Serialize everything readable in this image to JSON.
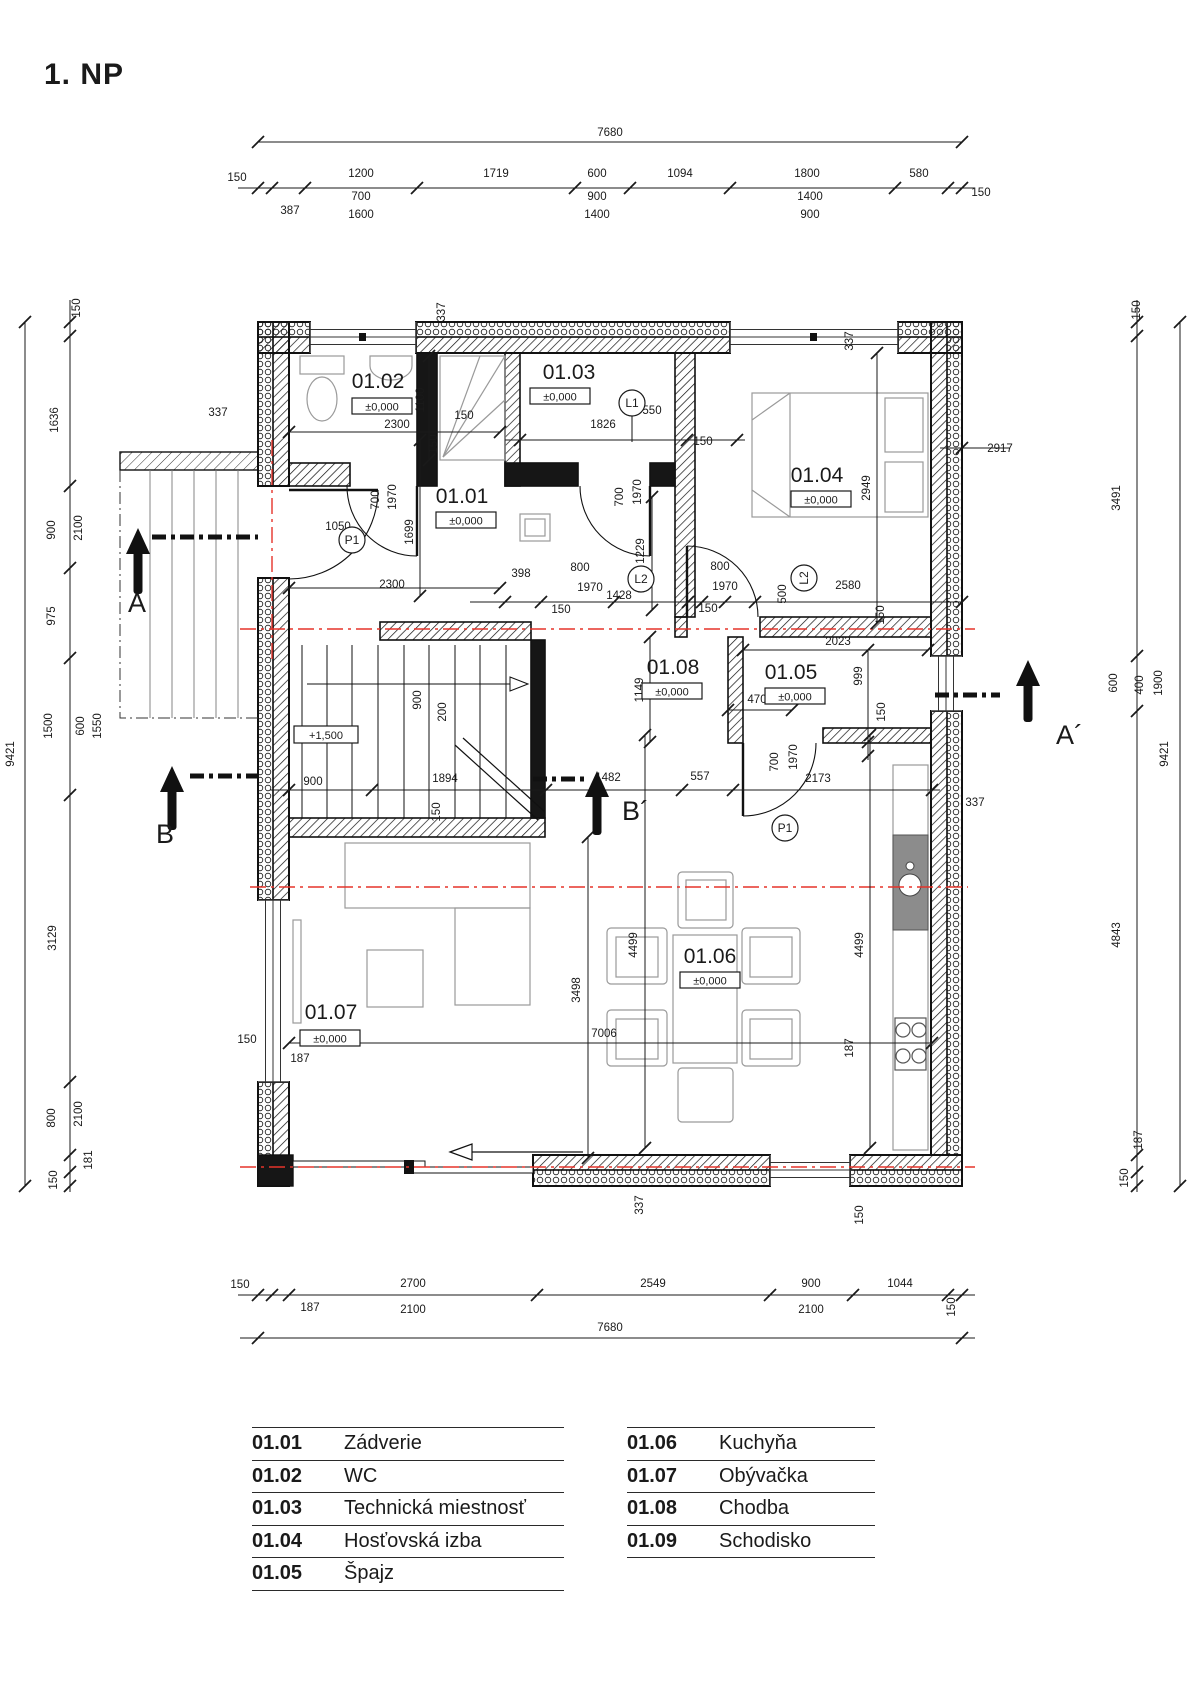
{
  "title": "1. NP",
  "colors": {
    "line": "#1a1a1a",
    "wall_fill": "#161616",
    "furniture": "#9a9a9a",
    "red_axis": "#e5332a"
  },
  "legend": {
    "columns": [
      {
        "rows": [
          {
            "code": "01.01",
            "name": "Zádverie"
          },
          {
            "code": "01.02",
            "name": "WC"
          },
          {
            "code": "01.03",
            "name": "Technická miestnosť"
          },
          {
            "code": "01.04",
            "name": "Hosťovská izba"
          },
          {
            "code": "01.05",
            "name": "Špajz"
          }
        ]
      },
      {
        "rows": [
          {
            "code": "01.06",
            "name": "Kuchyňa"
          },
          {
            "code": "01.07",
            "name": "Obývačka"
          },
          {
            "code": "01.08",
            "name": "Chodba"
          },
          {
            "code": "01.09",
            "name": "Schodisko"
          }
        ]
      }
    ]
  },
  "rooms": [
    {
      "code": "01.02",
      "elev": "±0,000",
      "x": 378,
      "y": 388,
      "bx": 382,
      "by": 398
    },
    {
      "code": "01.03",
      "elev": "±0,000",
      "x": 569,
      "y": 379,
      "bx": 560,
      "by": 388
    },
    {
      "code": "01.04",
      "elev": "±0,000",
      "x": 817,
      "y": 482,
      "bx": 821,
      "by": 491
    },
    {
      "code": "01.01",
      "elev": "±0,000",
      "x": 462,
      "y": 503,
      "bx": 466,
      "by": 512
    },
    {
      "code": "01.08",
      "elev": "±0,000",
      "x": 673,
      "y": 674,
      "bx": 672,
      "by": 683
    },
    {
      "code": "01.05",
      "elev": "±0,000",
      "x": 791,
      "y": 679,
      "bx": 795,
      "by": 688
    },
    {
      "code": "01.06",
      "elev": "±0,000",
      "x": 710,
      "y": 963,
      "bx": 710,
      "by": 972
    },
    {
      "code": "01.07",
      "elev": "±0,000",
      "x": 331,
      "y": 1019,
      "bx": 330,
      "by": 1030
    }
  ],
  "extra_boxes": [
    {
      "t": "+1,500",
      "x": 326,
      "y": 738
    }
  ],
  "door_tags": [
    {
      "t": "L1",
      "x": 632,
      "y": 403,
      "r": 0
    },
    {
      "t": "L2",
      "x": 641,
      "y": 579,
      "r": 0
    },
    {
      "t": "L2",
      "x": 804,
      "y": 578,
      "r": 1
    },
    {
      "t": "P1",
      "x": 352,
      "y": 540,
      "r": 0
    },
    {
      "t": "P1",
      "x": 785,
      "y": 828,
      "r": 0
    }
  ],
  "sections": [
    {
      "label": "A",
      "lx": 128,
      "ly": 612,
      "line": [
        152,
        537,
        258,
        537
      ],
      "ax": 138,
      "atip": 528,
      "atail": 594
    },
    {
      "label": "A´",
      "lx": 1056,
      "ly": 744,
      "line": [
        935,
        695,
        1000,
        695
      ],
      "ax": 1028,
      "atip": 660,
      "atail": 722
    },
    {
      "label": "B",
      "lx": 156,
      "ly": 843,
      "line": [
        190,
        776,
        258,
        776
      ],
      "ax": 172,
      "atip": 766,
      "atail": 830
    },
    {
      "label": "B´",
      "lx": 622,
      "ly": 820,
      "line": [
        533,
        779,
        585,
        779
      ],
      "ax": 597,
      "atip": 771,
      "atail": 835
    }
  ],
  "dim_lines": [
    {
      "x1": 258,
      "y1": 142,
      "x2": 962,
      "y2": 142,
      "t": [
        [
          258,
          142
        ],
        [
          962,
          142
        ]
      ]
    },
    {
      "x1": 238,
      "y1": 188,
      "x2": 975,
      "y2": 188,
      "t": [
        [
          258,
          188
        ],
        [
          272,
          188
        ],
        [
          305,
          188
        ],
        [
          417,
          188
        ],
        [
          575,
          188
        ],
        [
          630,
          188
        ],
        [
          730,
          188
        ],
        [
          895,
          188
        ],
        [
          948,
          188
        ],
        [
          962,
          188
        ]
      ]
    },
    {
      "x1": 25,
      "y1": 322,
      "x2": 25,
      "y2": 1186,
      "t": [
        [
          25,
          322
        ],
        [
          25,
          1186
        ]
      ]
    },
    {
      "x1": 70,
      "y1": 300,
      "x2": 70,
      "y2": 1192,
      "t": [
        [
          70,
          322
        ],
        [
          70,
          336
        ],
        [
          70,
          486
        ],
        [
          70,
          568
        ],
        [
          70,
          658
        ],
        [
          70,
          795
        ],
        [
          70,
          1082
        ],
        [
          70,
          1155
        ],
        [
          70,
          1172
        ],
        [
          70,
          1186
        ]
      ]
    },
    {
      "x1": 1137,
      "y1": 300,
      "x2": 1137,
      "y2": 1192,
      "t": [
        [
          1137,
          322
        ],
        [
          1137,
          336
        ],
        [
          1137,
          656
        ],
        [
          1137,
          711
        ],
        [
          1137,
          1155
        ],
        [
          1137,
          1172
        ],
        [
          1137,
          1186
        ]
      ]
    },
    {
      "x1": 1180,
      "y1": 322,
      "x2": 1180,
      "y2": 1186,
      "t": [
        [
          1180,
          322
        ],
        [
          1180,
          1186
        ]
      ]
    },
    {
      "x1": 238,
      "y1": 1295,
      "x2": 975,
      "y2": 1295,
      "t": [
        [
          258,
          1295
        ],
        [
          272,
          1295
        ],
        [
          289,
          1295
        ],
        [
          537,
          1295
        ],
        [
          770,
          1295
        ],
        [
          853,
          1295
        ],
        [
          948,
          1295
        ],
        [
          962,
          1295
        ]
      ]
    },
    {
      "x1": 240,
      "y1": 1338,
      "x2": 975,
      "y2": 1338,
      "t": [
        [
          258,
          1338
        ],
        [
          962,
          1338
        ]
      ]
    },
    {
      "x1": 289,
      "y1": 432,
      "x2": 500,
      "y2": 432,
      "t": [
        [
          289,
          432
        ],
        [
          500,
          432
        ]
      ]
    },
    {
      "x1": 505,
      "y1": 440,
      "x2": 745,
      "y2": 440,
      "t": [
        [
          520,
          440
        ],
        [
          687,
          440
        ],
        [
          737,
          440
        ]
      ]
    },
    {
      "x1": 429,
      "y1": 356,
      "x2": 429,
      "y2": 460,
      "t": [
        [
          429,
          356
        ],
        [
          429,
          460
        ]
      ]
    },
    {
      "x1": 420,
      "y1": 440,
      "x2": 420,
      "y2": 596,
      "t": [
        [
          420,
          440
        ],
        [
          420,
          596
        ]
      ]
    },
    {
      "x1": 289,
      "y1": 588,
      "x2": 500,
      "y2": 588,
      "t": [
        [
          289,
          588
        ],
        [
          500,
          588
        ]
      ]
    },
    {
      "x1": 470,
      "y1": 602,
      "x2": 962,
      "y2": 602,
      "t": [
        [
          505,
          602
        ],
        [
          541,
          602
        ],
        [
          614,
          602
        ],
        [
          688,
          602
        ],
        [
          702,
          602
        ],
        [
          725,
          602
        ],
        [
          755,
          602
        ],
        [
          962,
          602
        ]
      ]
    },
    {
      "x1": 652,
      "y1": 497,
      "x2": 652,
      "y2": 610,
      "t": [
        [
          652,
          497
        ],
        [
          652,
          610
        ]
      ]
    },
    {
      "x1": 743,
      "y1": 650,
      "x2": 928,
      "y2": 650,
      "t": [
        [
          743,
          650
        ],
        [
          928,
          650
        ]
      ]
    },
    {
      "x1": 868,
      "y1": 650,
      "x2": 868,
      "y2": 760,
      "t": [
        [
          868,
          650
        ],
        [
          868,
          742
        ],
        [
          868,
          756
        ]
      ]
    },
    {
      "x1": 650,
      "y1": 637,
      "x2": 650,
      "y2": 742,
      "t": [
        [
          650,
          637
        ],
        [
          650,
          742
        ]
      ]
    },
    {
      "x1": 877,
      "y1": 353,
      "x2": 877,
      "y2": 623,
      "t": [
        [
          877,
          353
        ],
        [
          877,
          623
        ]
      ]
    },
    {
      "x1": 940,
      "y1": 448,
      "x2": 1010,
      "y2": 448,
      "t": [
        [
          962,
          448
        ]
      ]
    },
    {
      "x1": 270,
      "y1": 790,
      "x2": 940,
      "y2": 790,
      "t": [
        [
          289,
          790
        ],
        [
          372,
          790
        ],
        [
          546,
          790
        ],
        [
          682,
          790
        ],
        [
          733,
          790
        ],
        [
          932,
          790
        ]
      ]
    },
    {
      "x1": 588,
      "y1": 837,
      "x2": 588,
      "y2": 1158,
      "t": [
        [
          588,
          837
        ],
        [
          588,
          1158
        ]
      ]
    },
    {
      "x1": 645,
      "y1": 735,
      "x2": 645,
      "y2": 1148,
      "t": [
        [
          645,
          735
        ],
        [
          645,
          1148
        ]
      ]
    },
    {
      "x1": 870,
      "y1": 735,
      "x2": 870,
      "y2": 1148,
      "t": [
        [
          870,
          735
        ],
        [
          870,
          1148
        ]
      ]
    },
    {
      "x1": 289,
      "y1": 1043,
      "x2": 932,
      "y2": 1043,
      "t": [
        [
          289,
          1043
        ],
        [
          932,
          1043
        ]
      ]
    },
    {
      "x1": 728,
      "y1": 710,
      "x2": 792,
      "y2": 710,
      "t": [
        [
          728,
          710
        ],
        [
          792,
          710
        ]
      ]
    }
  ],
  "dim_labels": [
    [
      "7680",
      610,
      136,
      0
    ],
    [
      "150",
      237,
      181,
      0
    ],
    [
      "1200",
      361,
      177,
      0
    ],
    [
      "1719",
      496,
      177,
      0
    ],
    [
      "600",
      597,
      177,
      0
    ],
    [
      "1094",
      680,
      177,
      0
    ],
    [
      "1800",
      807,
      177,
      0
    ],
    [
      "580",
      919,
      177,
      0
    ],
    [
      "150",
      981,
      196,
      0
    ],
    [
      "387",
      290,
      214,
      0
    ],
    [
      "700",
      361,
      200,
      0
    ],
    [
      "1600",
      361,
      218,
      0
    ],
    [
      "900",
      597,
      200,
      0
    ],
    [
      "1400",
      597,
      218,
      0
    ],
    [
      "1400",
      810,
      200,
      0
    ],
    [
      "900",
      810,
      218,
      0
    ],
    [
      "9421",
      14,
      754,
      1
    ],
    [
      "150",
      80,
      308,
      1
    ],
    [
      "1636",
      58,
      420,
      1
    ],
    [
      "900",
      55,
      530,
      1
    ],
    [
      "2100",
      82,
      528,
      1
    ],
    [
      "975",
      55,
      616,
      1
    ],
    [
      "1500",
      52,
      726,
      1
    ],
    [
      "600",
      84,
      726,
      1
    ],
    [
      "1550",
      101,
      726,
      1
    ],
    [
      "3129",
      56,
      938,
      1
    ],
    [
      "800",
      55,
      1118,
      1
    ],
    [
      "2100",
      82,
      1114,
      1
    ],
    [
      "181",
      92,
      1160,
      1
    ],
    [
      "150",
      57,
      1180,
      1
    ],
    [
      "150",
      1140,
      310,
      1
    ],
    [
      "3491",
      1120,
      498,
      1
    ],
    [
      "600",
      1117,
      683,
      1
    ],
    [
      "400",
      1143,
      685,
      1
    ],
    [
      "1900",
      1162,
      683,
      1
    ],
    [
      "4843",
      1120,
      935,
      1
    ],
    [
      "187",
      1142,
      1140,
      1
    ],
    [
      "150",
      1128,
      1178,
      1
    ],
    [
      "9421",
      1168,
      754,
      1
    ],
    [
      "150",
      240,
      1288,
      0
    ],
    [
      "2700",
      413,
      1287,
      0
    ],
    [
      "2549",
      653,
      1287,
      0
    ],
    [
      "900",
      811,
      1287,
      0
    ],
    [
      "1044",
      900,
      1287,
      0
    ],
    [
      "150",
      955,
      1307,
      1
    ],
    [
      "187",
      310,
      1311,
      0
    ],
    [
      "2100",
      413,
      1313,
      0
    ],
    [
      "2100",
      811,
      1313,
      0
    ],
    [
      "7680",
      610,
      1331,
      0
    ],
    [
      "337",
      445,
      312,
      1
    ],
    [
      "1100",
      424,
      400,
      1
    ],
    [
      "337",
      218,
      416,
      0
    ],
    [
      "2300",
      397,
      428,
      0
    ],
    [
      "150",
      437,
      444,
      1
    ],
    [
      "150",
      464,
      419,
      0
    ],
    [
      "1826",
      603,
      428,
      0
    ],
    [
      "550",
      652,
      414,
      0
    ],
    [
      "150",
      703,
      445,
      0
    ],
    [
      "700",
      379,
      500,
      1
    ],
    [
      "1970",
      396,
      497,
      1
    ],
    [
      "1050",
      338,
      530,
      0
    ],
    [
      "1699",
      413,
      532,
      1
    ],
    [
      "2300",
      392,
      588,
      0
    ],
    [
      "398",
      521,
      577,
      0
    ],
    [
      "800",
      580,
      571,
      0
    ],
    [
      "1970",
      590,
      591,
      0
    ],
    [
      "1428",
      619,
      599,
      0
    ],
    [
      "150",
      561,
      613,
      0
    ],
    [
      "700",
      623,
      497,
      1
    ],
    [
      "1970",
      641,
      492,
      1
    ],
    [
      "1229",
      644,
      551,
      1
    ],
    [
      "800",
      720,
      570,
      0
    ],
    [
      "1970",
      725,
      590,
      0
    ],
    [
      "150",
      708,
      612,
      0
    ],
    [
      "500",
      786,
      594,
      1
    ],
    [
      "2580",
      848,
      589,
      0
    ],
    [
      "2917",
      1000,
      452,
      0
    ],
    [
      "2949",
      870,
      488,
      1
    ],
    [
      "337",
      853,
      341,
      1
    ],
    [
      "2023",
      838,
      645,
      0
    ],
    [
      "999",
      862,
      676,
      1
    ],
    [
      "150",
      885,
      712,
      1
    ],
    [
      "470",
      757,
      703,
      0
    ],
    [
      "150",
      884,
      615,
      1
    ],
    [
      "900",
      313,
      785,
      0
    ],
    [
      "1894",
      445,
      782,
      0
    ],
    [
      "1482",
      608,
      781,
      0
    ],
    [
      "557",
      700,
      780,
      0
    ],
    [
      "2173",
      818,
      782,
      0
    ],
    [
      "700",
      778,
      762,
      1
    ],
    [
      "1970",
      797,
      757,
      1
    ],
    [
      "900",
      421,
      700,
      1
    ],
    [
      "200",
      446,
      712,
      1
    ],
    [
      "150",
      440,
      812,
      1
    ],
    [
      "1149",
      643,
      690,
      1
    ],
    [
      "337",
      975,
      806,
      0
    ],
    [
      "3498",
      580,
      990,
      1
    ],
    [
      "4499",
      637,
      945,
      1
    ],
    [
      "4499",
      863,
      945,
      1
    ],
    [
      "7006",
      604,
      1037,
      0
    ],
    [
      "150",
      247,
      1043,
      0
    ],
    [
      "187",
      300,
      1062,
      0
    ],
    [
      "187",
      853,
      1048,
      1
    ],
    [
      "337",
      643,
      1205,
      1
    ],
    [
      "150",
      863,
      1215,
      1
    ]
  ]
}
